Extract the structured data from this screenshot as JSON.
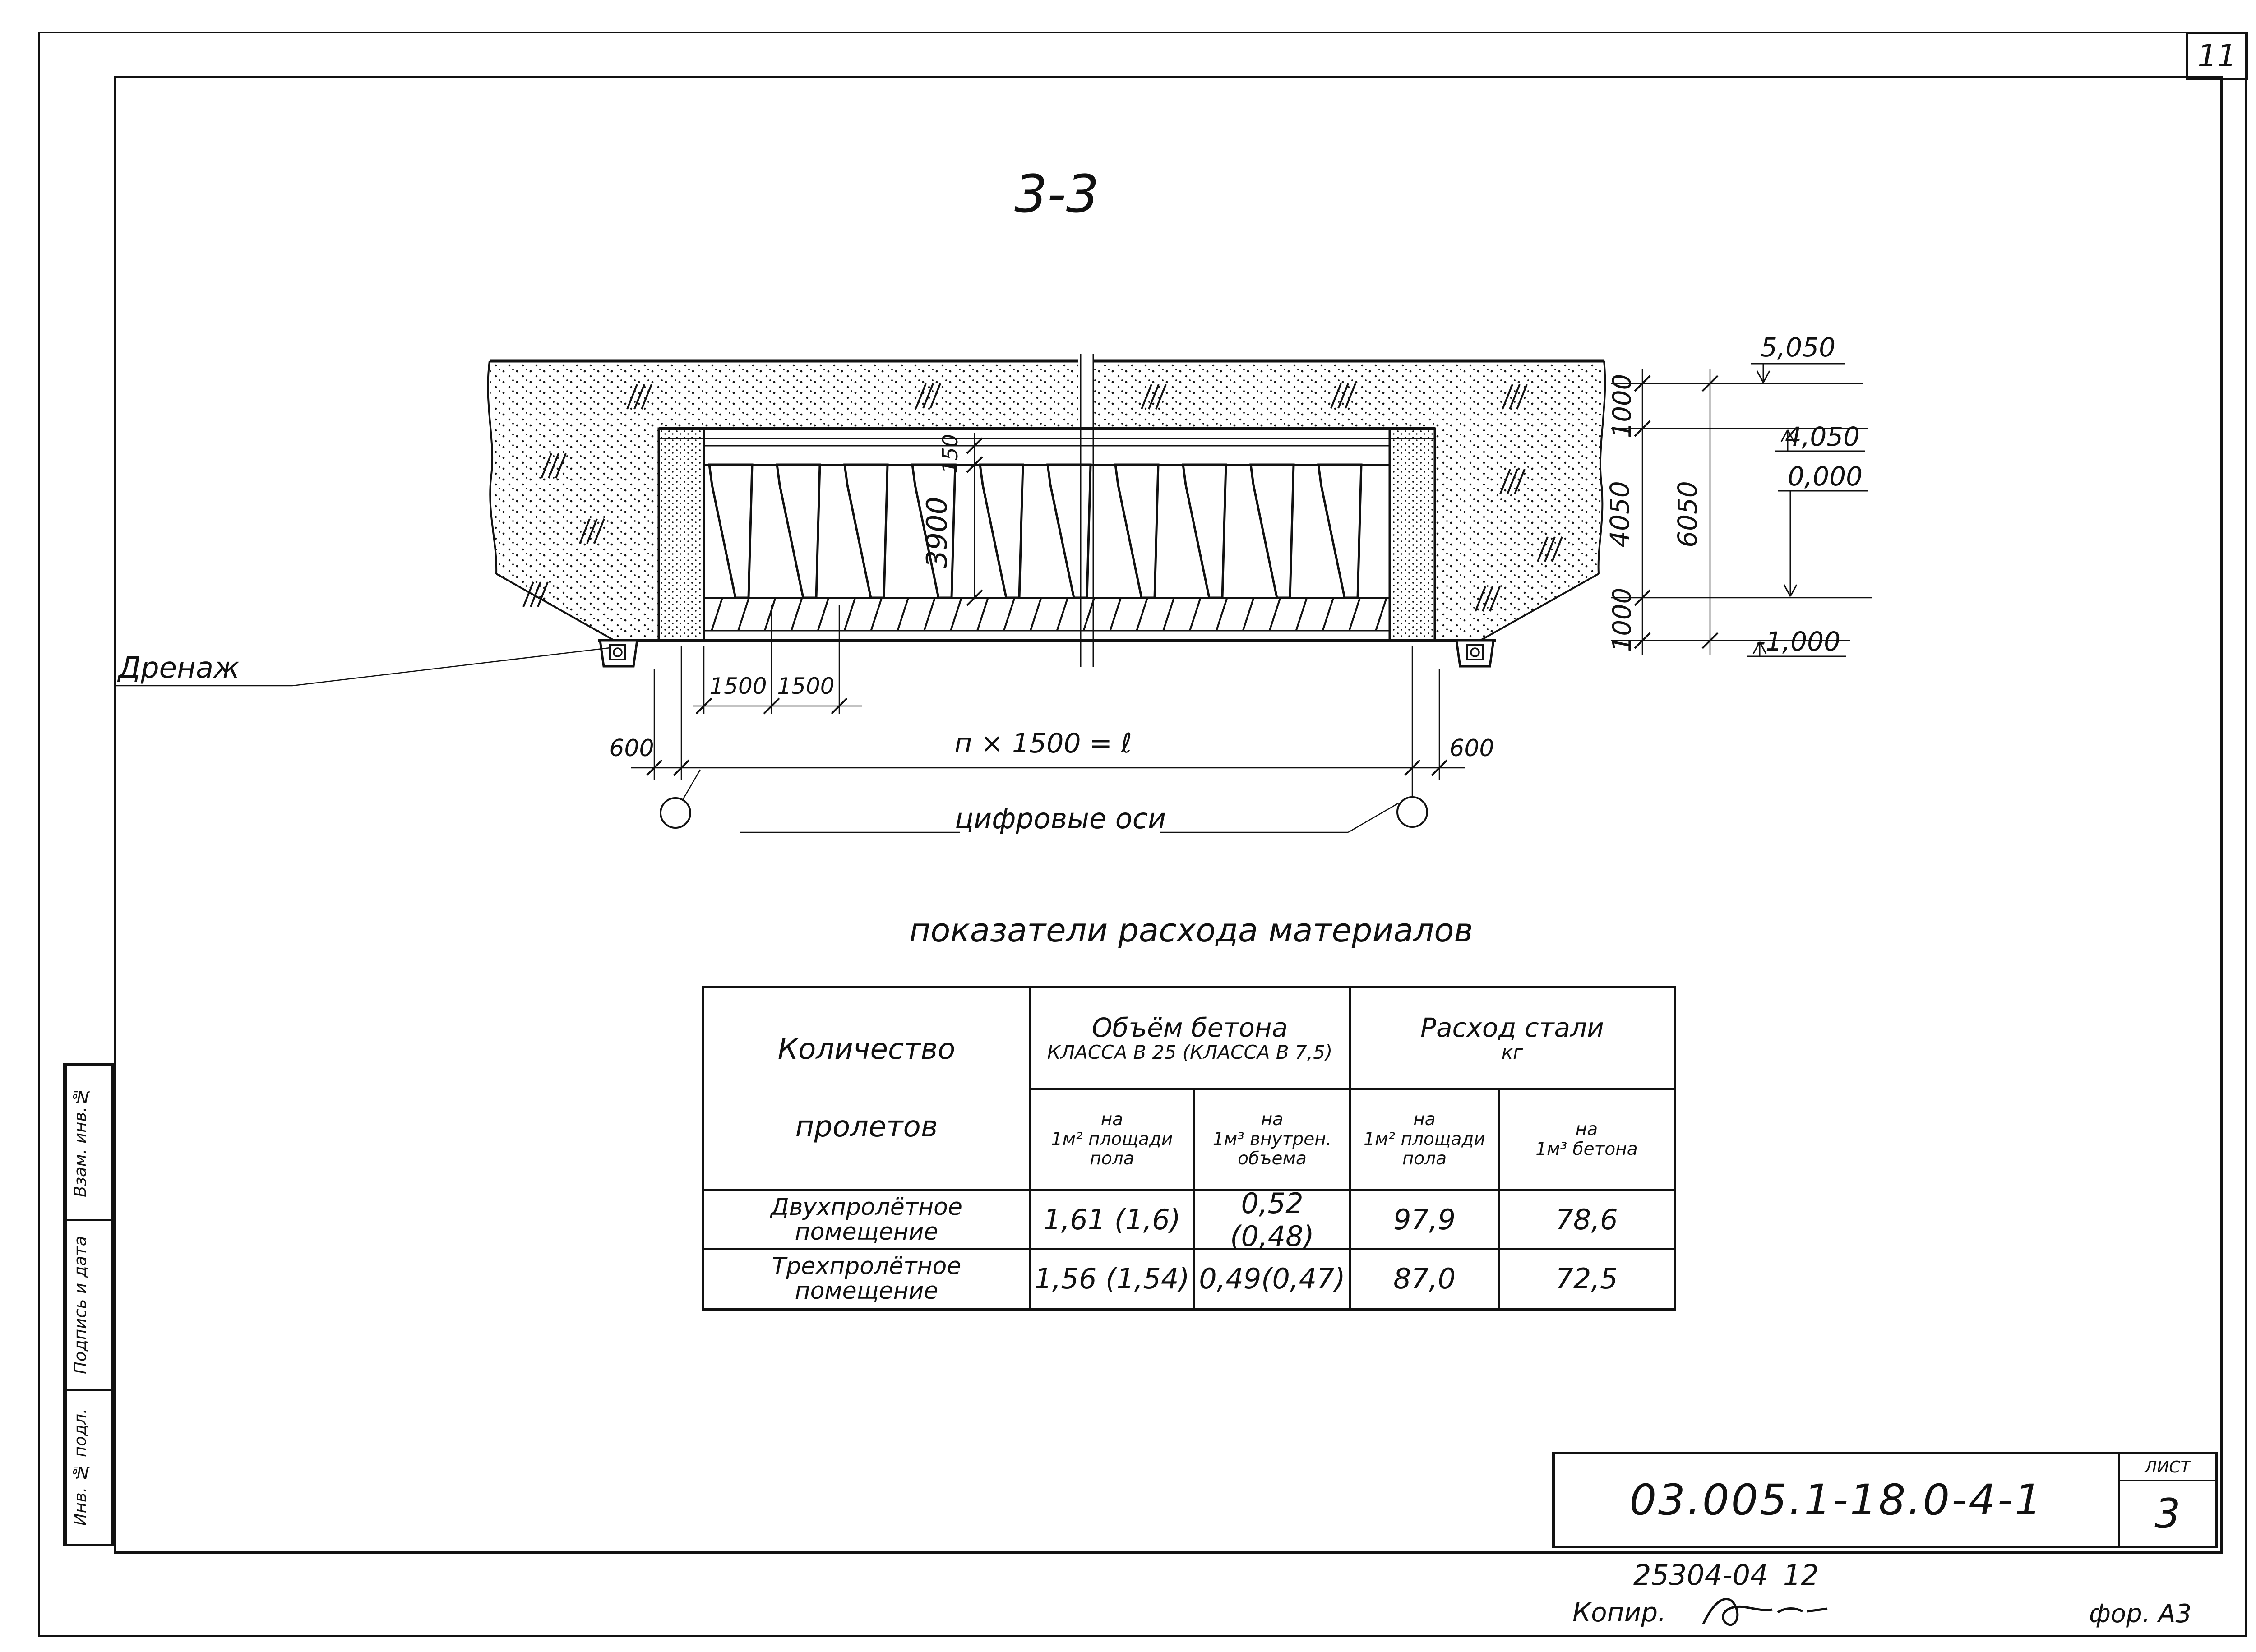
{
  "sheet": {
    "page_number": "11",
    "doc_number": "03.005.1-18.0-4-1",
    "sheet_label": "ЛИСТ",
    "sheet_number": "3",
    "order_code": "25304-04",
    "order_qty": "12",
    "copy_label": "Копир.",
    "format_label": "фор. А3",
    "margin_stamps": [
      "Взам. инв.№",
      "Подпись и дата",
      "Инв. № подл."
    ]
  },
  "drawing": {
    "section_title": "3-3",
    "labels": {
      "drainage": "Дренаж",
      "axes_note": "цифровые оси",
      "span_formula": "п × 1500 = ℓ"
    },
    "dims": {
      "slab": "150",
      "height": "3900",
      "top_offset": "1000",
      "inner_height": "4050",
      "total_height": "6050",
      "bottom_offset": "1000",
      "edge_left": "600",
      "edge_right": "600",
      "spacing_a": "1500",
      "spacing_b": "1500"
    },
    "elevations": {
      "ground": "5,050",
      "ceiling": "4,050",
      "floor": "0,000",
      "base": "-1,000"
    }
  },
  "table": {
    "title": "показатели  расхода  материалов",
    "col_spans": {
      "line1": "Количество",
      "line2": "пролетов"
    },
    "group_concrete": {
      "line1": "Объём  бетона",
      "line2": "КЛАССА В 25 (КЛАССА В 7,5)"
    },
    "group_steel": {
      "line1": "Расход стали",
      "line2": "кг"
    },
    "sub_headers": [
      {
        "l1": "на",
        "l2": "1м² площади",
        "l3": "пола"
      },
      {
        "l1": "на",
        "l2": "1м³ внутрен.",
        "l3": "объема"
      },
      {
        "l1": "на",
        "l2": "1м² площади",
        "l3": "пола"
      },
      {
        "l1": "на",
        "l2": "1м³ бетона",
        "l3": ""
      }
    ],
    "rows": [
      {
        "name1": "Двухпролётное",
        "name2": "помещение",
        "v1": "1,61 (1,6)",
        "v2": "0,52 (0,48)",
        "v3": "97,9",
        "v4": "78,6"
      },
      {
        "name1": "Трехпролётное",
        "name2": "помещение",
        "v1": "1,56 (1,54)",
        "v2": "0,49(0,47)",
        "v3": "87,0",
        "v4": "72,5"
      }
    ]
  }
}
